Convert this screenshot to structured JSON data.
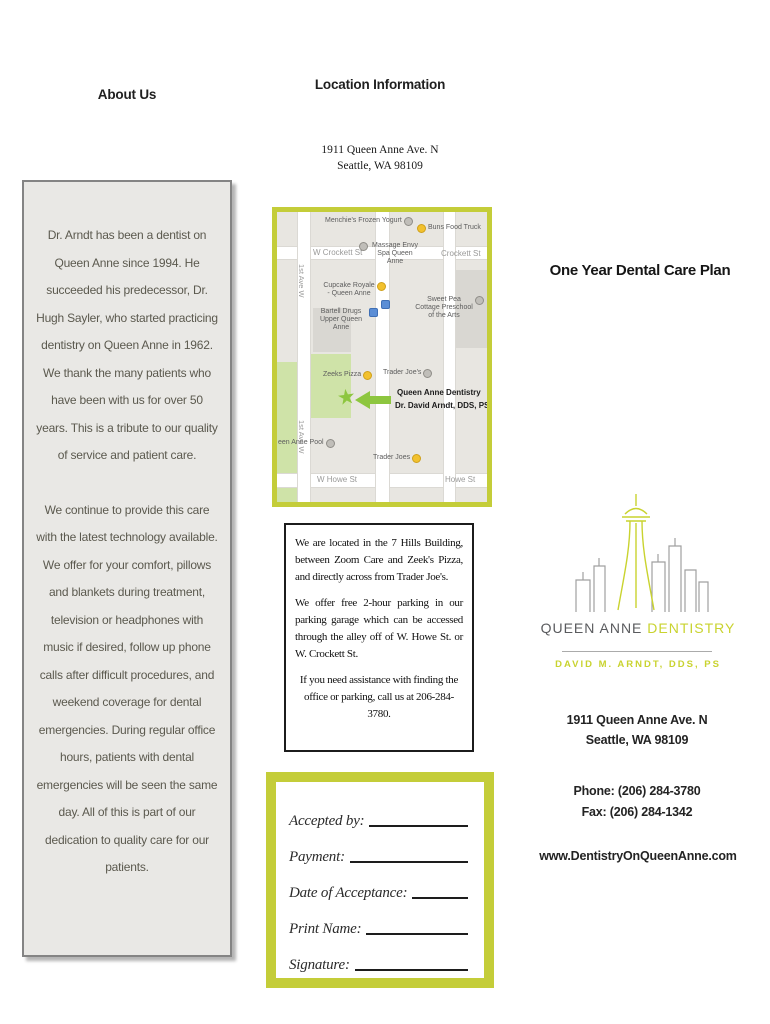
{
  "left": {
    "heading": "About Us",
    "about": {
      "p1": "Dr. Arndt has been a dentist on Queen Anne since 1994. He succeeded his predecessor, Dr. Hugh Sayler, who started practicing dentistry on Queen Anne in 1962. We thank the many patients who have been with us for over 50 years. This is a tribute to our quality of service and patient care.",
      "p2": "We continue to provide this care with the latest technology available. We offer for your comfort, pillows and blankets during treatment, television or headphones with music if desired, follow up phone calls after difficult procedures, and weekend coverage for dental emergencies. During regular office hours, patients with dental emergencies will be seen the same day. All of this is part of our dedication to quality care for our patients."
    }
  },
  "middle": {
    "heading": "Location Information",
    "address1": "1911 Queen Anne Ave. N",
    "address2": "Seattle, WA 98109",
    "map": {
      "labels": [
        {
          "text": "Menchie's Frozen Yogurt"
        },
        {
          "text": "Buns Food Truck"
        },
        {
          "text": "W Crockett St"
        },
        {
          "text": "Massage Envy Spa Queen Anne"
        },
        {
          "text": "Crockett St"
        },
        {
          "text": "Cupcake Royale - Queen Anne"
        },
        {
          "text": "Sweet Pea Cottage Preschool of the Arts"
        },
        {
          "text": "Bartell Drugs Upper Queen Anne"
        },
        {
          "text": "1st Ave W"
        },
        {
          "text": "Zeeks Pizza"
        },
        {
          "text": "Trader Joe's"
        },
        {
          "text": "Queen Anne Dentistry"
        },
        {
          "text": "Dr. David Arndt, DDS, PS"
        },
        {
          "text": "een Anne Pool"
        },
        {
          "text": "Trader Joes"
        },
        {
          "text": "W Howe St"
        },
        {
          "text": "Howe St"
        },
        {
          "text": "1st Ave W"
        }
      ]
    },
    "info": {
      "p1": "We are located in the 7 Hills Building, between Zoom Care and Zeek's Pizza, and directly across from Trader Joe's.",
      "p2": "We offer free 2-hour parking in our parking garage which can be accessed through the alley off of W. Howe St. or W. Crockett St.",
      "p3": "If you need assistance with finding the office or parking, call us at 206-284-3780."
    },
    "form": {
      "fields": [
        {
          "label": "Accepted by:"
        },
        {
          "label": "Payment:"
        },
        {
          "label": "Date of Acceptance:"
        },
        {
          "label": "Print Name:"
        },
        {
          "label": "Signature:"
        }
      ]
    }
  },
  "right": {
    "heading": "One Year Dental Care Plan",
    "logo": {
      "name_gray": "QUEEN ANNE",
      "name_green": " DENTISTRY",
      "tagline": "DAVID M. ARNDT, DDS, PS"
    },
    "address1": "1911 Queen Anne Ave. N",
    "address2": "Seattle, WA 98109",
    "phone": "Phone: (206) 284-3780",
    "fax": "Fax: (206) 284-1342",
    "website": "www.DentistryOnQueenAnne.com"
  },
  "colors": {
    "accent_green": "#c4cd39",
    "logo_green": "#c9d32f",
    "arrow_green": "#8dc63f",
    "box_gray": "#e9e8e5",
    "text_gray": "#5b594e"
  }
}
